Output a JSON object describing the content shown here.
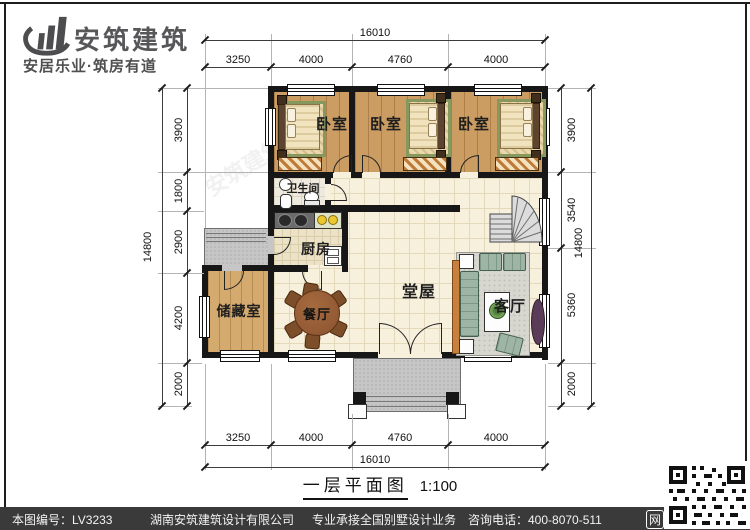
{
  "logo": {
    "name": "安筑建筑",
    "tagline": "安居乐业·筑房有道"
  },
  "plan": {
    "rooms": {
      "bedroom1": "卧室",
      "bedroom2": "卧室",
      "bedroom3": "卧室",
      "bathroom": "卫生间",
      "kitchen": "厨房",
      "dining": "餐厅",
      "storage": "储藏室",
      "hall": "堂屋",
      "living": "客厅"
    }
  },
  "dimensions": {
    "top": {
      "overall": "16010",
      "seg1": "3250",
      "seg2": "4000",
      "seg3": "4760",
      "seg4": "4000"
    },
    "bottom": {
      "overall": "16010",
      "seg1": "3250",
      "seg2": "4000",
      "seg3": "4760",
      "seg4": "4000"
    },
    "left": {
      "overall": "14800",
      "seg1": "3900",
      "seg2": "1800",
      "seg3": "2900",
      "seg4": "4200",
      "seg5": "2000"
    },
    "right": {
      "overall": "14800",
      "seg1": "3900",
      "seg2": "3540",
      "seg3": "5360",
      "seg4": "2000"
    }
  },
  "title": {
    "name": "一层平面图",
    "scale": "1:100"
  },
  "watermark": {
    "text": "安筑建筑",
    "text2": "zjz·com"
  },
  "footer": {
    "sheet_no": "本图编号：LV3233",
    "company": "湖南安筑建筑设计有限公司",
    "service": "专业承接全国别墅设计业务",
    "phone": "咨询电话：400-8070-511",
    "net_label": "网"
  },
  "colors": {
    "wall": "#171717",
    "wood": "#cb9d62",
    "tile": "#f7f0dc",
    "porch_gray": "#c6c6c6",
    "rug_green": "#87985f",
    "footer_bg": "#3a3a3a"
  }
}
